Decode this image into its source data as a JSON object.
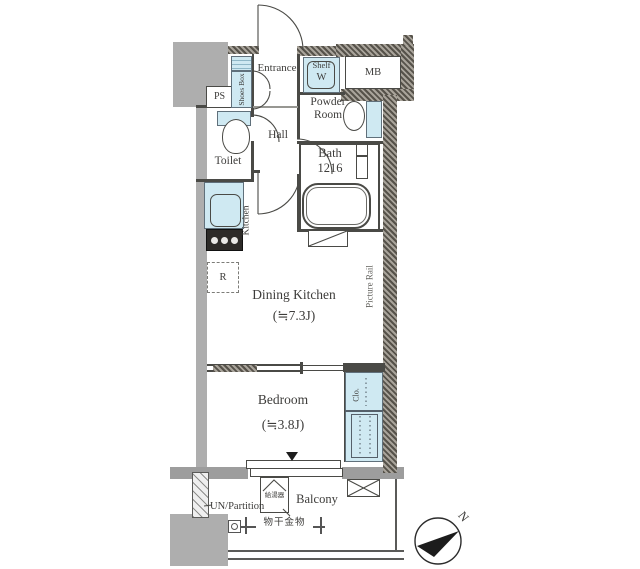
{
  "title": "apartment-floor-plan",
  "colors": {
    "wall": "#4a4a46",
    "hatch_dark": "#56524a",
    "hatch_light": "#a8a39a",
    "concrete": "#aeaeae",
    "fixture_fill": "#cfe9f2",
    "text": "#3d3c3a"
  },
  "labels": {
    "ps": "PS",
    "shoes_box": "Shoes Box",
    "entrance": "Entrance",
    "shelf": "Shelf",
    "washing_machine": "W",
    "meter_box": "MB",
    "powder_room_1": "Powder",
    "powder_room_2": "Room",
    "hall": "Hall",
    "toilet": "Toilet",
    "bath": "Bath",
    "bath_size": "1216",
    "kitchen": "Kitchen",
    "refrigerator": "R",
    "dining_kitchen": "Dining Kitchen",
    "dining_kitchen_area": "(≒7.3J)",
    "picture_rail": "Picture Rail",
    "bedroom": "Bedroom",
    "bedroom_area": "(≒3.8J)",
    "closet": "Clo.",
    "un_partition": "UN/Partition",
    "water_heater": "給湯器",
    "balcony": "Balcony",
    "laundry_fitting": "物干金物",
    "compass_north": "N"
  }
}
